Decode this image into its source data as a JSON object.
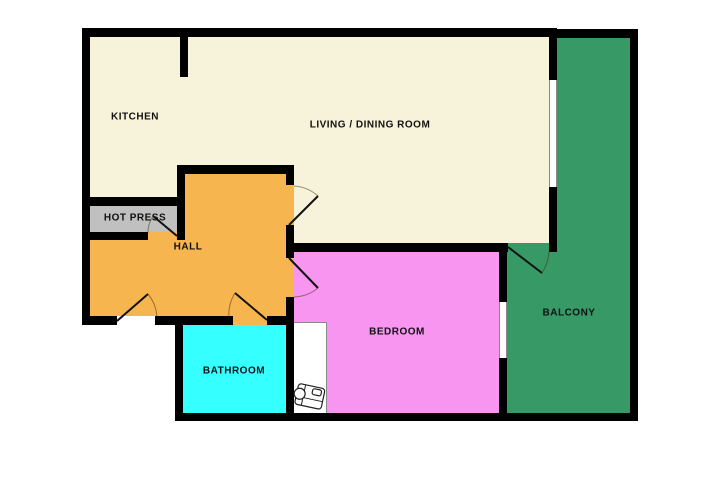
{
  "title": "Apartment floor plan",
  "rooms": [
    {
      "id": "kitchen",
      "label": "KITCHEN",
      "color": "#f7f3da"
    },
    {
      "id": "living_dining",
      "label": "LIVING / DINING ROOM",
      "color": "#f7f3da"
    },
    {
      "id": "hot_press",
      "label": "HOT PRESS",
      "color": "#c0c0c0"
    },
    {
      "id": "hall",
      "label": "HALL",
      "color": "#f6b54f"
    },
    {
      "id": "bathroom",
      "label": "BATHROOM",
      "color": "#35ffff"
    },
    {
      "id": "bedroom",
      "label": "BEDROOM",
      "color": "#f895f0"
    },
    {
      "id": "balcony",
      "label": "BALCONY",
      "color": "#379966"
    }
  ],
  "palette": {
    "wall": "#000000",
    "window_frame": "#8a8a8a",
    "door_leaf": "#111111",
    "door_swing_arc": "#7a6a45",
    "background": "#ffffff",
    "closet_outline": "#8a8a8a"
  },
  "icons": [
    {
      "name": "furniture-icon",
      "description": "small furniture item drawn in wardrobe nook beside bathroom"
    }
  ]
}
